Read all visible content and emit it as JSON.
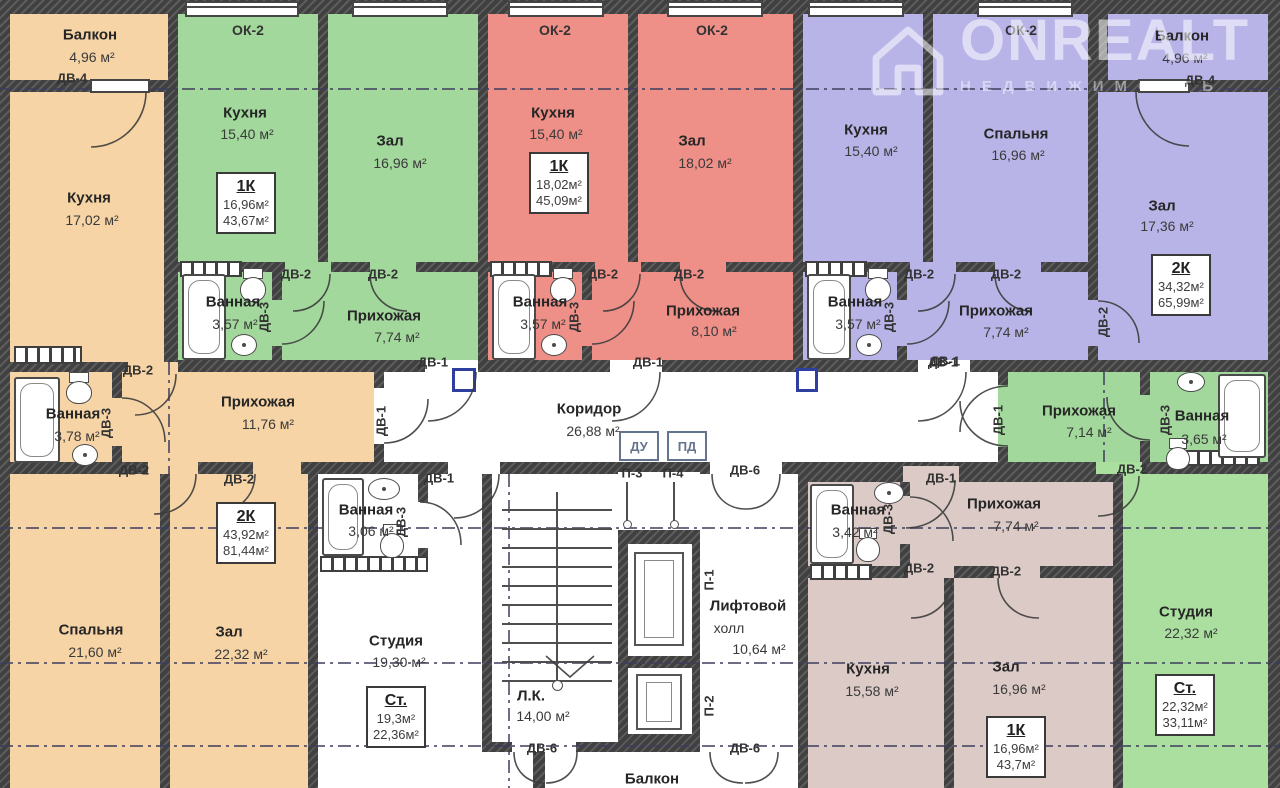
{
  "watermark": {
    "brand": "ONREALT",
    "subtitle": "НЕДВИЖИМОСТЬ"
  },
  "colors": {
    "wall": "#404040",
    "orange": "#f6d4a6",
    "green": "#a3d89c",
    "red": "#ee8f88",
    "purple": "#b8b4e8",
    "brown": "#dbcac6",
    "light_green": "#aadfa0",
    "white_room": "#ffffff",
    "axis": "#3c3c5c",
    "panel_blue": "#2f3f9e"
  },
  "labels": {
    "dv1": "ДВ-1",
    "dv2": "ДВ-2",
    "dv3": "ДВ-3",
    "dv4": "ДВ-4",
    "dv6": "ДВ-6",
    "p1": "П-1",
    "p2": "П-2",
    "p3": "П-3",
    "p4": "П-4",
    "du": "ДУ",
    "pd": "ПД",
    "ok2": "ОК-2"
  },
  "rooms": {
    "balcony_left": {
      "name": "Балкон",
      "area": "4,96 м²"
    },
    "kitchen_left": {
      "name": "Кухня",
      "area": "17,02 м²"
    },
    "bath_left": {
      "name": "Ванная",
      "area": "3,78 м²"
    },
    "entry_left": {
      "name": "Прихожая",
      "area": "11,76 м²"
    },
    "bedroom_left": {
      "name": "Спальня",
      "area": "21,60 м²"
    },
    "hall_left": {
      "name": "Зал",
      "area": "22,32 м²"
    },
    "kitchen_green": {
      "name": "Кухня",
      "area": "15,40 м²"
    },
    "hall_green": {
      "name": "Зал",
      "area": "16,96 м²"
    },
    "bath_green": {
      "name": "Ванная",
      "area": "3,57 м²"
    },
    "entry_green": {
      "name": "Прихожая",
      "area": "7,74 м²"
    },
    "kitchen_red": {
      "name": "Кухня",
      "area": "15,40 м²"
    },
    "hall_red": {
      "name": "Зал",
      "area": "18,02 м²"
    },
    "bath_red": {
      "name": "Ванная",
      "area": "3,57 м²"
    },
    "entry_red": {
      "name": "Прихожая",
      "area": "8,10 м²"
    },
    "kitchen_purple": {
      "name": "Кухня",
      "area": "15,40 м²"
    },
    "bedroom_purple": {
      "name": "Спальня",
      "area": "16,96 м²"
    },
    "balcony_right": {
      "name": "Балкон",
      "area": "4,96 м²"
    },
    "hall_purple": {
      "name": "Зал",
      "area": "17,36 м²"
    },
    "bath_purple": {
      "name": "Ванная",
      "area": "3,57 м²"
    },
    "entry_purple": {
      "name": "Прихожая",
      "area": "7,74 м²"
    },
    "corridor": {
      "name": "Коридор",
      "area": "26,88 м²"
    },
    "entry_right": {
      "name": "Прихожая",
      "area": "7,14 м²"
    },
    "bath_right": {
      "name": "Ванная",
      "area": "3,65 м²"
    },
    "bath_studio": {
      "name": "Ванная",
      "area": "3,06 м²"
    },
    "studio_left": {
      "name": "Студия",
      "area": "19,30 м²"
    },
    "stairs": {
      "name": "Л.К.",
      "area": "14,00 м²"
    },
    "lift_hall": {
      "line1": "Лифтовой",
      "line2": "холл",
      "area": "10,64 м²"
    },
    "balcony_bottom": {
      "name": "Балкон"
    },
    "bath_brown": {
      "name": "Ванная",
      "area": "3,42 м²"
    },
    "entry_brown": {
      "name": "Прихожая",
      "area": "7,74 м²"
    },
    "kitchen_brown": {
      "name": "Кухня",
      "area": "15,58 м²"
    },
    "hall_brown": {
      "name": "Зал",
      "area": "16,96 м²"
    },
    "studio_right": {
      "name": "Студия",
      "area": "22,32 м²"
    }
  },
  "tags": {
    "green": {
      "type": "1К",
      "living": "16,96м²",
      "total": "43,67м²"
    },
    "red": {
      "type": "1К",
      "living": "18,02м²",
      "total": "45,09м²"
    },
    "purple": {
      "type": "2К",
      "living": "34,32м²",
      "total": "65,99м²"
    },
    "left": {
      "type": "2К",
      "living": "43,92м²",
      "total": "81,44м²"
    },
    "studio_left": {
      "type": "Ст.",
      "living": "19,3м²",
      "total": "22,36м²"
    },
    "brown": {
      "type": "1К",
      "living": "16,96м²",
      "total": "43,7м²"
    },
    "studio_right": {
      "type": "Ст.",
      "living": "22,32м²",
      "total": "33,11м²"
    }
  }
}
